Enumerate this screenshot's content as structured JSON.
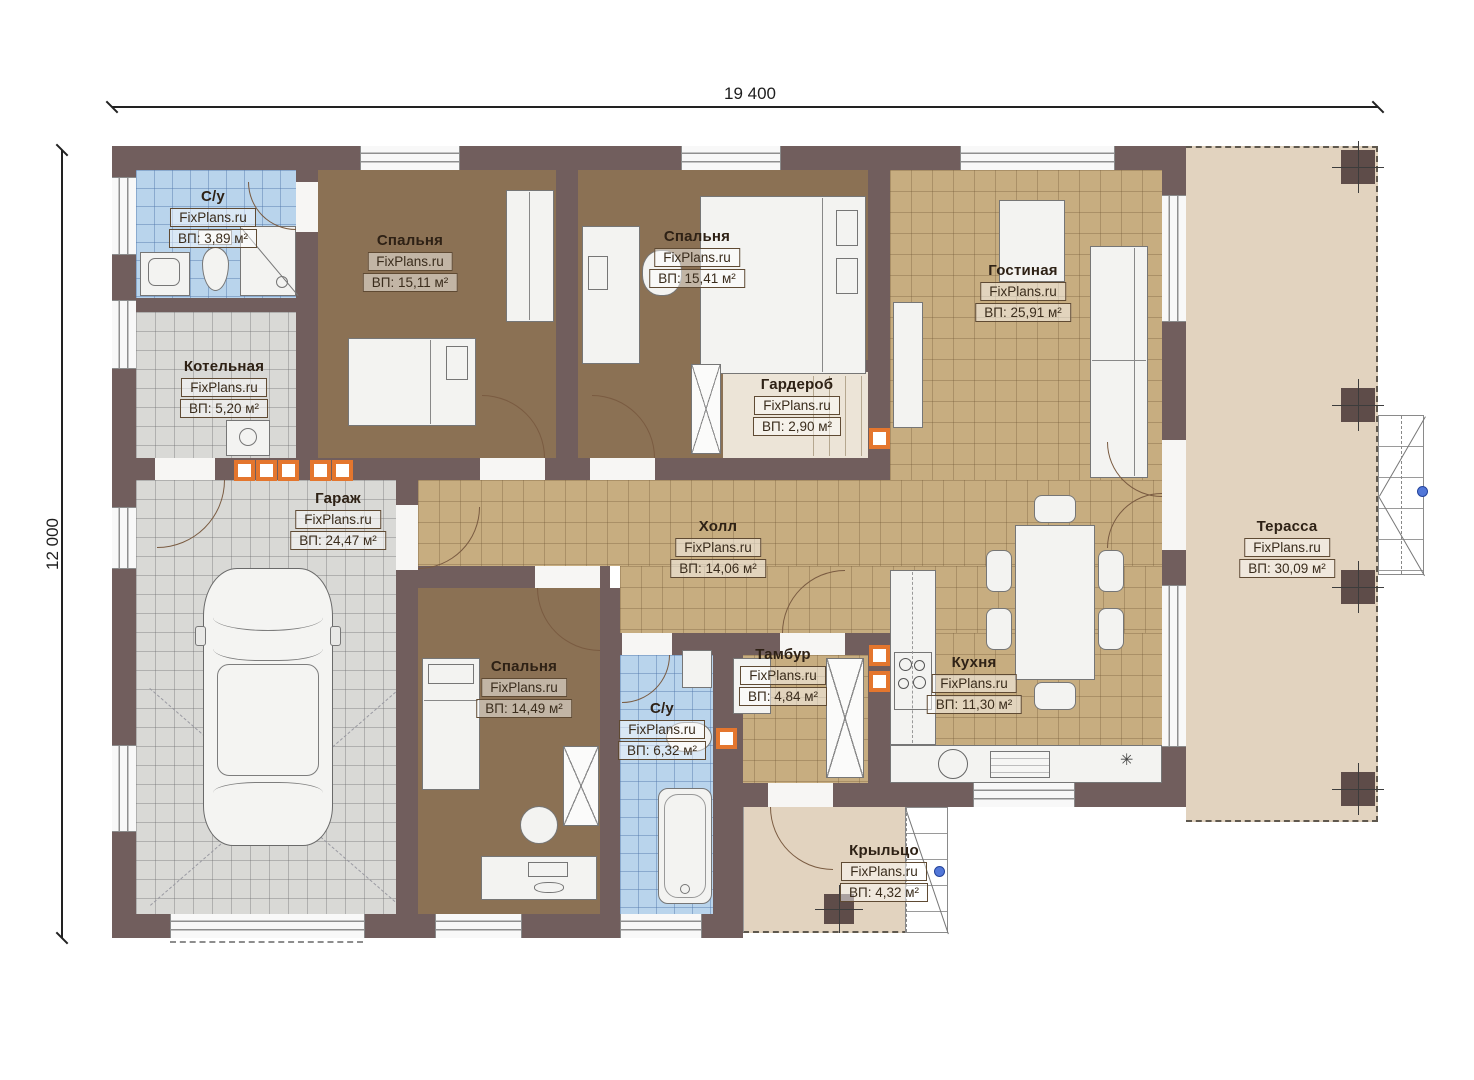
{
  "dimensions": {
    "width": "19 400",
    "height": "12 000"
  },
  "watermark": "FixPlans.ru",
  "rooms": [
    {
      "name": "С/у",
      "watermark": "FixPlans.ru",
      "area": "ВП: 3,89 м²"
    },
    {
      "name": "Спальня",
      "watermark": "FixPlans.ru",
      "area": "ВП: 15,11 м²"
    },
    {
      "name": "Спальня",
      "watermark": "FixPlans.ru",
      "area": "ВП: 15,41 м²"
    },
    {
      "name": "Котельная",
      "watermark": "FixPlans.ru",
      "area": "ВП: 5,20 м²"
    },
    {
      "name": "Гардероб",
      "watermark": "FixPlans.ru",
      "area": "ВП: 2,90 м²"
    },
    {
      "name": "Гостиная",
      "watermark": "FixPlans.ru",
      "area": "ВП: 25,91 м²"
    },
    {
      "name": "Гараж",
      "watermark": "FixPlans.ru",
      "area": "ВП: 24,47 м²"
    },
    {
      "name": "Холл",
      "watermark": "FixPlans.ru",
      "area": "ВП: 14,06 м²"
    },
    {
      "name": "Спальня",
      "watermark": "FixPlans.ru",
      "area": "ВП: 14,49 м²"
    },
    {
      "name": "С/у",
      "watermark": "FixPlans.ru",
      "area": "ВП: 6,32 м²"
    },
    {
      "name": "Тамбур",
      "watermark": "FixPlans.ru",
      "area": "ВП: 4,84 м²"
    },
    {
      "name": "Кухня",
      "watermark": "FixPlans.ru",
      "area": "ВП: 11,30 м²"
    },
    {
      "name": "Терасса",
      "watermark": "FixPlans.ru",
      "area": "ВП: 30,09 м²"
    },
    {
      "name": "Крыльцо",
      "watermark": "FixPlans.ru",
      "area": "ВП: 4,32 м²"
    }
  ],
  "colors": {
    "wall": "#715e5d",
    "floor_bedroom": "#8b7154",
    "floor_tile_tan": "#c7ad80",
    "floor_tile_gray": "#d9d9d6",
    "floor_tile_blue": "#b9d4ec",
    "floor_outdoor": "#e2d3bf",
    "vent_accent": "#e4762e",
    "marker_blue": "#5277d8"
  }
}
